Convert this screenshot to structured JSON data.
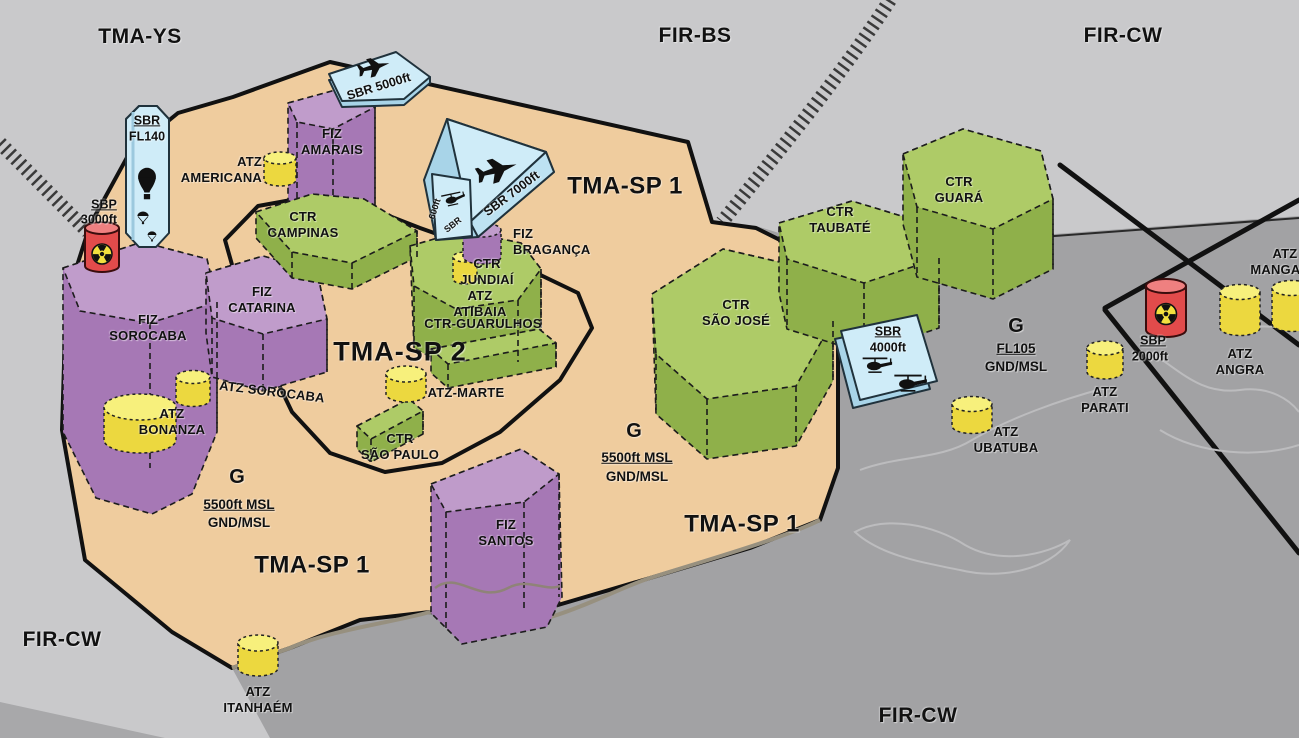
{
  "colors": {
    "background_gray": "#c9c9cb",
    "sea_gray": "#a2a2a4",
    "tma_tan": "#efcc9e",
    "ctr_green_top": "#aecb67",
    "ctr_green_side": "#8fb04a",
    "fiz_purple_top": "#c09ccb",
    "fiz_purple_side": "#a678b5",
    "atz_yellow_top": "#f7f07c",
    "atz_yellow_body": "#ecd83f",
    "sbr_blue": "#cfecf8",
    "sbp_red": "#e24b4b",
    "boundary_black": "#111111"
  },
  "region_labels": {
    "tma_ys": "TMA-YS",
    "fir_bs": "FIR-BS",
    "fir_cw_top": "FIR-CW",
    "fir_cw_bottom_left": "FIR-CW",
    "fir_cw_bottom_center": "FIR-CW"
  },
  "tma_labels": {
    "tma_sp1_top": "TMA-SP 1",
    "tma_sp1_mid": "TMA-SP 1",
    "tma_sp1_bottom": "TMA-SP 1",
    "tma_sp2": "TMA-SP 2"
  },
  "class_g_areas": {
    "east": {
      "class": "G",
      "limit": "5500ft MSL",
      "floor": "GND/MSL"
    },
    "west": {
      "class": "G",
      "limit": "5500ft MSL",
      "floor": "GND/MSL"
    },
    "coastal": {
      "class": "G",
      "limit": "FL105",
      "floor": "GND/MSL"
    }
  },
  "ctr_zones": {
    "campinas": "CTR\nCAMPINAS",
    "jundiai": "CTR\nJUNDIAÍ",
    "guarulhos": "CTR-GUARULHOS",
    "sao_paulo": "CTR\nSÃO PAULO",
    "sao_jose": "CTR\nSÃO JOSÉ",
    "taubate": "CTR\nTAUBATÉ",
    "guara": "CTR\nGUARÁ"
  },
  "fiz_zones": {
    "amarais": "FIZ\nAMARAIS",
    "catarina": "FIZ\nCATARINA",
    "sorocaba": "FIZ\nSOROCABA",
    "santos": "FIZ\nSANTOS",
    "braganca": "FIZ\nBRAGANÇA"
  },
  "atz_zones": {
    "americana": "ATZ\nAMERICANA",
    "atibaia": "ATZ\nATIBAIA",
    "marte": "ATZ-MARTE",
    "sorocaba": "ATZ SOROCABA",
    "bonanza": "ATZ\nBONANZA",
    "itanhaem": "ATZ\nITANHAÉM",
    "ubatuba": "ATZ\nUBATUBA",
    "parati": "ATZ\nPARATI",
    "angra": "ATZ\nANGRA",
    "mangaratiba": "ATZ\nMANGARA"
  },
  "restricted_areas": {
    "sbr_fl140": {
      "name": "SBR",
      "limit": "FL140",
      "icons": [
        "hot-air-balloon-icon",
        "parachute-icon"
      ]
    },
    "sbr_5000": {
      "label": "SBR 5000ft",
      "icons": [
        "airplane-icon"
      ]
    },
    "sbr_7000": {
      "label": "SBR 7000ft",
      "side_name": "SBR",
      "side_limit": "600ft",
      "icons": [
        "airplane-icon",
        "helicopter-icon"
      ]
    },
    "sbr_4000": {
      "name": "SBR",
      "limit": "4000ft",
      "icons": [
        "helicopter-icon",
        "helicopter-icon"
      ]
    }
  },
  "prohibited_areas": {
    "sbp_west": {
      "name": "SBP",
      "limit": "3000ft",
      "icons": [
        "radioactive-icon"
      ]
    },
    "sbp_east": {
      "name": "SBP",
      "limit": "2000ft",
      "icons": [
        "radioactive-icon"
      ]
    }
  }
}
